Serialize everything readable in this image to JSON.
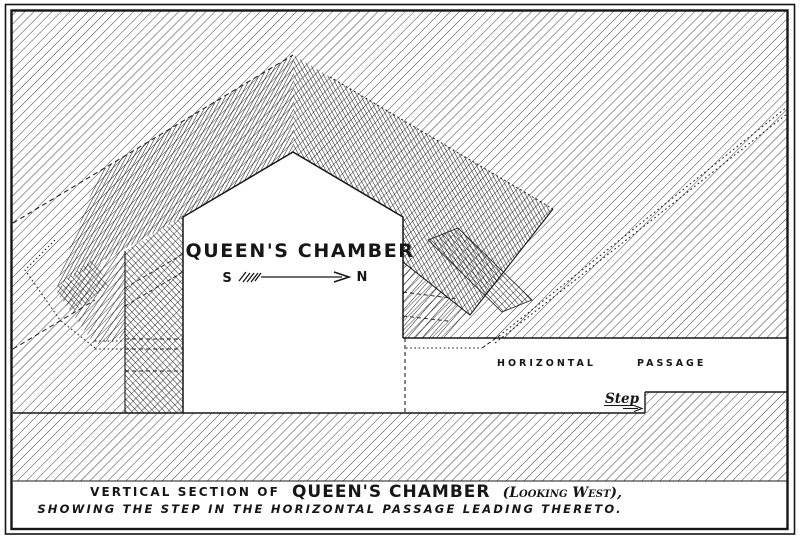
{
  "figure": {
    "chamber_label": "QUEEN'S CHAMBER",
    "compass_south": "S",
    "compass_north": "N",
    "passage_word_1": "HORIZONTAL",
    "passage_word_2": "PASSAGE",
    "step_label": "Step",
    "caption_line1_lead": "VERTICAL SECTION OF",
    "caption_line1_title": "QUEEN'S CHAMBER",
    "caption_line1_tail": "(Looking West),",
    "caption_line2": "SHOWING THE STEP IN THE HORIZONTAL PASSAGE LEADING THERETO.",
    "icons": {
      "north_arrow": "south-to-north-arrow",
      "step_arrow": "step-pointer-arrow"
    },
    "colors": {
      "ink": "#1a1a1a",
      "paper": "#ffffff"
    }
  }
}
